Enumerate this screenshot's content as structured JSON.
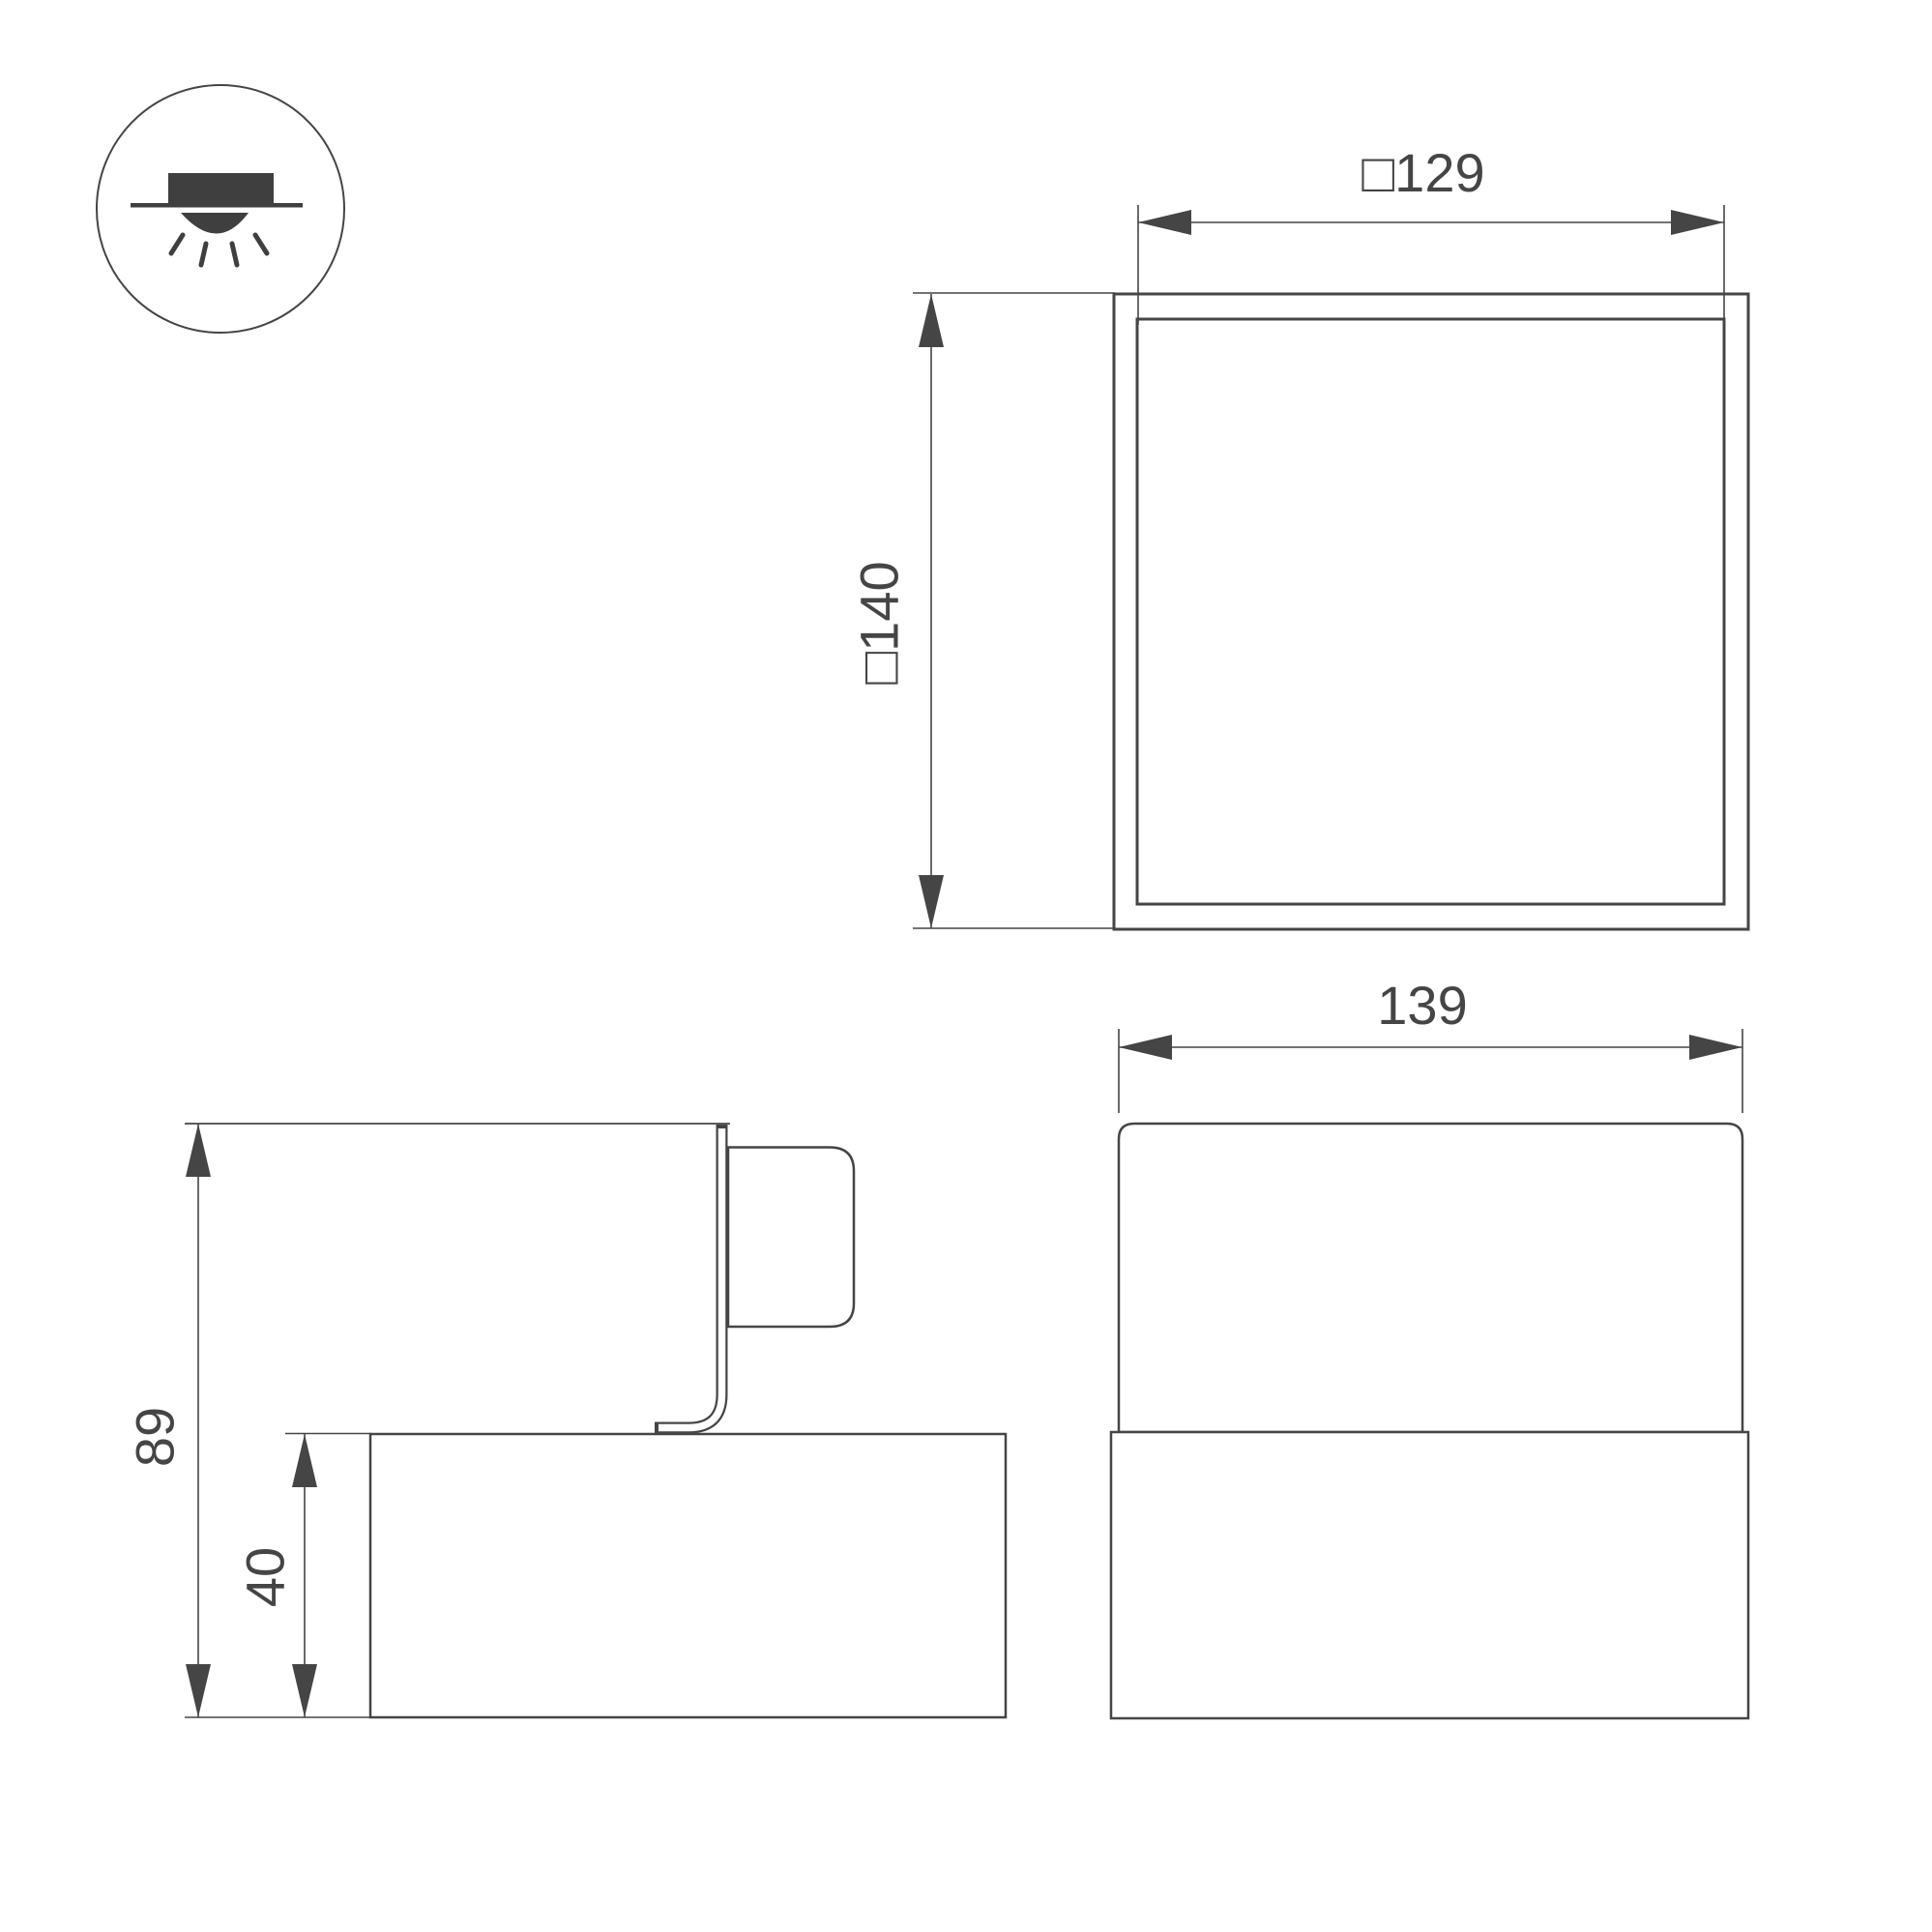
{
  "page": {
    "background": "#ffffff",
    "stroke_color": "#454545",
    "icon_fill": "#3f3f3f"
  },
  "drawing": {
    "icon": {
      "name": "recessed-ceiling-downlight-mounting-icon"
    },
    "views": {
      "top": {
        "width_dim": "□129",
        "outer_dim": "□140"
      },
      "side": {
        "overall_height_dim": "89",
        "base_height_dim": "40"
      },
      "front": {
        "width_dim": "139"
      }
    }
  }
}
